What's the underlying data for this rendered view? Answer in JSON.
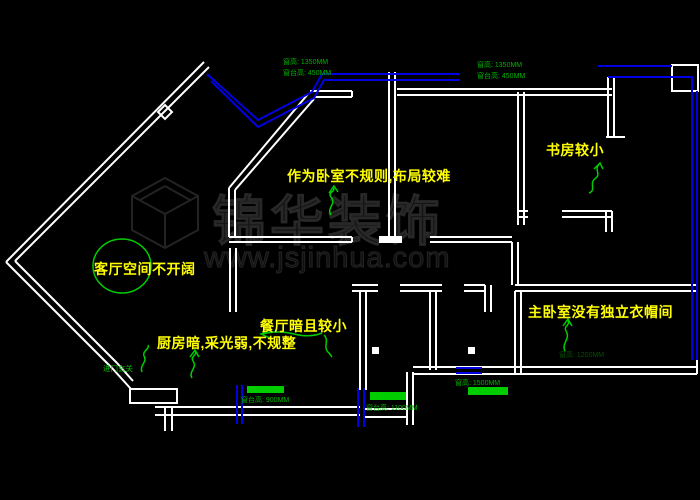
{
  "canvas": {
    "width": 700,
    "height": 500,
    "background": "#000000"
  },
  "colors": {
    "wall": "#ffffff",
    "window": "#0000e0",
    "annotation_text": "#ffff00",
    "leader_green": "#00cc00",
    "label_green": "#00b400",
    "watermark_gray": "#1c1c1c"
  },
  "watermark": {
    "brand": "锦华装饰",
    "url": "www.jsjinhua.com",
    "logo": "cube-logo"
  },
  "annotations": {
    "bedroom": "作为卧室不规则,布局较难",
    "study": "书房较小",
    "living": "客厅空间不开阔",
    "dining": "餐厅暗且较小",
    "kitchen": "厨房暗,采光弱,不规整",
    "master": "主卧室没有独立衣帽间",
    "entry": "进门玄关"
  },
  "window_labels": {
    "top_left_height": "窗高: 1350MM",
    "top_left_sill": "窗台高: 450MM",
    "top_mid_height": "窗高: 1350MM",
    "top_mid_sill": "窗台高: 450MM",
    "bottom_left_sill": "窗台高: 900MM",
    "bottom_mid_sill": "窗台高: 1100MM",
    "bottom_right_height": "窗高: 1500MM",
    "master_height": "窗高: 1200MM"
  }
}
